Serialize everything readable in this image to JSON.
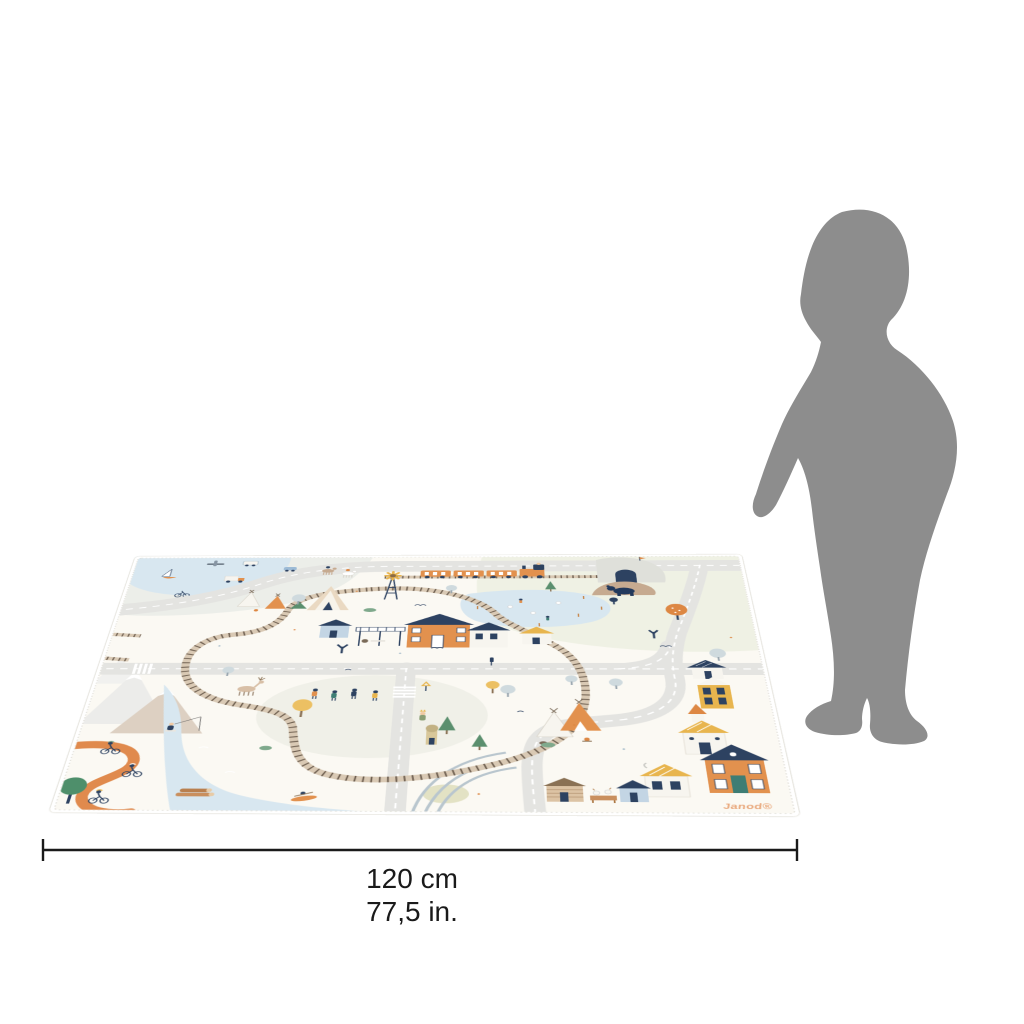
{
  "page": {
    "background_color": "#ffffff"
  },
  "product_mat": {
    "brand_text": "Janod®",
    "description": "illustrated village and railway road playmat shown in perspective",
    "base_color": "#fbf9f3",
    "accent_colors": {
      "navy": "#2d4261",
      "orange": "#e2914e",
      "yellow": "#e8b54e",
      "teal": "#3e7d74",
      "water_blue": "#d8e7f0",
      "track_tan": "#d9c9b4",
      "road_gray": "#e4e4e1",
      "bike_path_orange": "#e08a4d"
    },
    "features": [
      "railway-loop",
      "train",
      "tunnel",
      "windmill",
      "pond",
      "train-station",
      "roads",
      "crosswalks",
      "river",
      "mountains",
      "bike-path",
      "cyclists",
      "fisherman",
      "kayaker",
      "deer",
      "bear",
      "teepee-camps",
      "village-houses",
      "log-cabin",
      "trees",
      "hikers",
      "goats",
      "logs"
    ]
  },
  "scale_figure": {
    "kind": "toddler silhouette",
    "color": "#8d8d8d"
  },
  "dimension": {
    "width_cm": "120 cm",
    "width_in": "77,5 in.",
    "line_color": "#1a1a1a"
  }
}
